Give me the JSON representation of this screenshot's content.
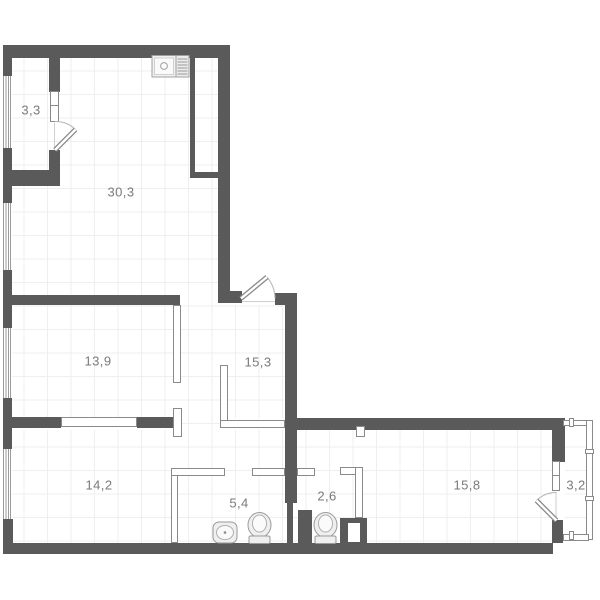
{
  "plan": {
    "title": "apartment floor plan",
    "rooms": [
      {
        "name": "balcony-top-left",
        "area": "3,3"
      },
      {
        "name": "kitchen-living-room",
        "area": "30,3"
      },
      {
        "name": "bedroom-left",
        "area": "13,9"
      },
      {
        "name": "hallway",
        "area": "15,3"
      },
      {
        "name": "bedroom-bottom-left",
        "area": "14,2"
      },
      {
        "name": "bathroom",
        "area": "5,4"
      },
      {
        "name": "wc",
        "area": "2,6"
      },
      {
        "name": "bedroom-bottom-right",
        "area": "15,8"
      },
      {
        "name": "balcony-right",
        "area": "3,2"
      }
    ],
    "fixtures": [
      {
        "name": "kitchen-sink"
      },
      {
        "name": "washbasin"
      },
      {
        "name": "toilet-bathroom"
      },
      {
        "name": "toilet-wc"
      }
    ],
    "colors": {
      "wall": "#5a5a5a",
      "partition_border": "#8a8a8a",
      "door_arc": "#b5b5b5",
      "floor_grid": "#efefef",
      "label_text": "#7a7a7a",
      "background": "#ffffff"
    }
  }
}
